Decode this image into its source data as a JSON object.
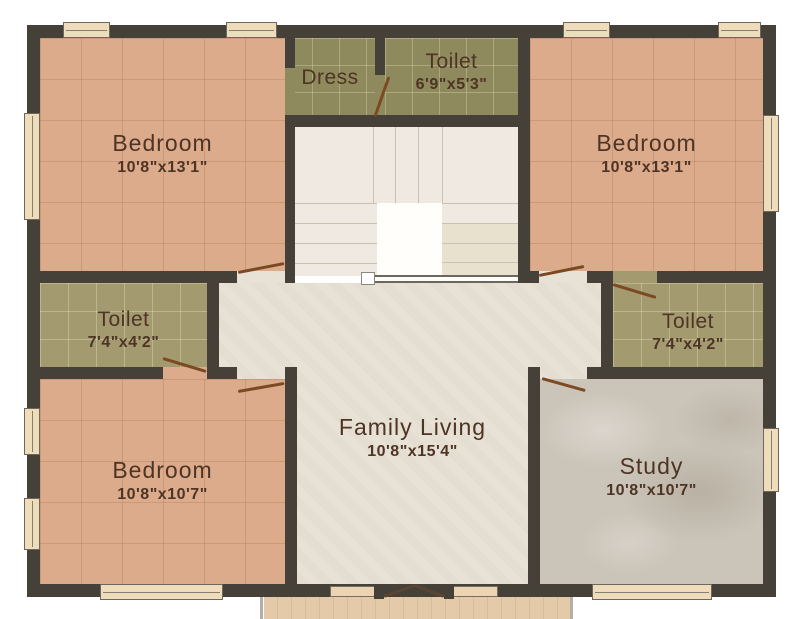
{
  "rooms": {
    "bedroom_top_left": {
      "name": "Bedroom",
      "dims": "10'8\"x13'1\""
    },
    "dress": {
      "name": "Dress"
    },
    "toilet_top": {
      "name": "Toilet",
      "dims": "6'9\"x5'3\""
    },
    "bedroom_top_right": {
      "name": "Bedroom",
      "dims": "10'8\"x13'1\""
    },
    "toilet_left": {
      "name": "Toilet",
      "dims": "7'4\"x4'2\""
    },
    "toilet_right": {
      "name": "Toilet",
      "dims": "7'4\"x4'2\""
    },
    "bedroom_bottom_left": {
      "name": "Bedroom",
      "dims": "10'8\"x10'7\""
    },
    "family_living": {
      "name": "Family Living",
      "dims": "10'8\"x15'4\""
    },
    "study": {
      "name": "Study",
      "dims": "10'8\"x10'7\""
    }
  },
  "colors": {
    "wall": "#454139",
    "bedroom_floor": "#dcab8b",
    "dress_toilet_floor": "#8f8a5e",
    "side_toilet_floor": "#a39a70",
    "living_floor": "#e8e2d6",
    "study_floor": "#cbc4b8",
    "stairs_floor": "#efe9e2",
    "balcony_floor": "#e2c8a6",
    "door_leaf": "#7b4a22",
    "window_fill": "#eedcba",
    "label_text": "#4e3424"
  }
}
